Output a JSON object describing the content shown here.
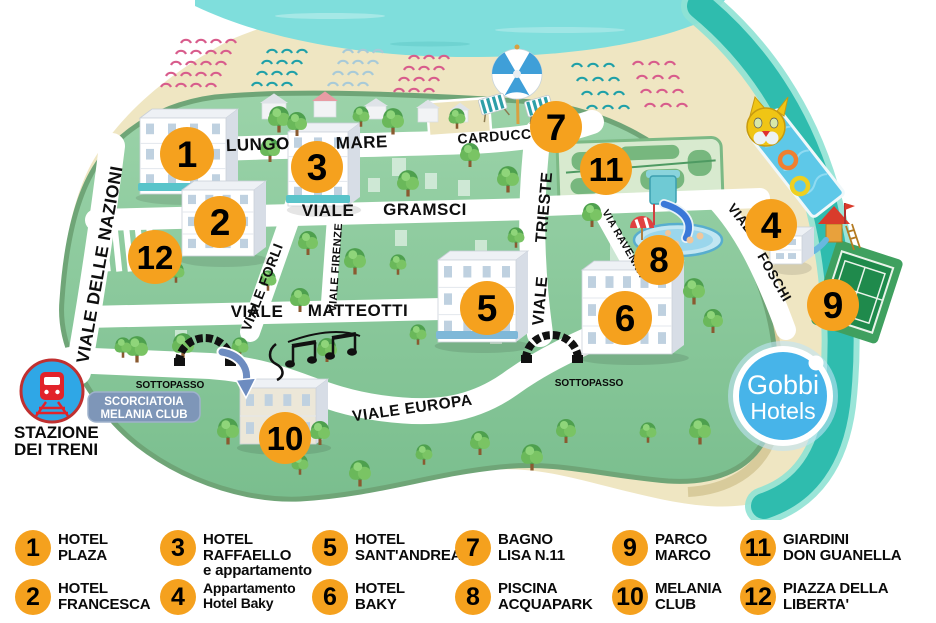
{
  "colors": {
    "marker_orange": "#F5A11E",
    "sea_turquoise": "#7FDEDC",
    "shore_teal": "#2FBCAE",
    "sand": "#EFE6C2",
    "land_green": "#8CC9A0",
    "street_white": "#FFFFFF",
    "label_black": "#111111",
    "scorciatoia_blue": "#7E96B8",
    "station_blue": "#2FA7E6",
    "train_red": "#E2232A",
    "gobbi_blue": "#47B4E9"
  },
  "map": {
    "marker_numbers": [
      "1",
      "2",
      "3",
      "4",
      "5",
      "6",
      "7",
      "8",
      "9",
      "10",
      "11",
      "12"
    ],
    "streets": {
      "nazioni": "VIALE DELLE NAZIONI",
      "lungo": "LUNGO",
      "mare": "MARE",
      "carducci": "CARDUCCI",
      "gramsci_word1": "VIALE",
      "gramsci_word2": "GRAMSCI",
      "matteotti_word1": "VIALE",
      "matteotti_word2": "MATTEOTTI",
      "trieste_word1": "VIALE",
      "trieste_word2": "TRIESTE",
      "forli": "VIALE FORLI",
      "firenze": "VIALE FIRENZE",
      "ravenna": "VIA RAVENNA",
      "foschi_word1": "VIALE",
      "foschi_word2": "FOSCHI",
      "europa": "VIALE EUROPA"
    },
    "labels": {
      "sottopasso_left": "SOTTOPASSO",
      "sottopasso_right": "SOTTOPASSO",
      "scorciatoia_line1": "SCORCIATOIA",
      "scorciatoia_line2": "MELANIA CLUB",
      "station_line1": "STAZIONE",
      "station_line2": "DEI TRENI",
      "gobbi_line1": "Gobbi",
      "gobbi_line2": "Hotels"
    }
  },
  "legend": {
    "items": [
      {
        "num": "1",
        "lines": [
          "HOTEL",
          "PLAZA"
        ]
      },
      {
        "num": "2",
        "lines": [
          "HOTEL",
          "FRANCESCA"
        ]
      },
      {
        "num": "3",
        "lines": [
          "HOTEL",
          "RAFFAELLO",
          "e appartamento"
        ]
      },
      {
        "num": "4",
        "lines": [
          "Appartamento",
          "Hotel Baky"
        ]
      },
      {
        "num": "5",
        "lines": [
          "HOTEL",
          "SANT'ANDREA"
        ]
      },
      {
        "num": "6",
        "lines": [
          "HOTEL",
          "BAKY"
        ]
      },
      {
        "num": "7",
        "lines": [
          "BAGNO",
          "LISA N.11"
        ]
      },
      {
        "num": "8",
        "lines": [
          "PISCINA",
          "ACQUAPARK"
        ]
      },
      {
        "num": "9",
        "lines": [
          "PARCO",
          "MARCO"
        ]
      },
      {
        "num": "10",
        "lines": [
          "MELANIA",
          "CLUB"
        ]
      },
      {
        "num": "11",
        "lines": [
          "GIARDINI",
          "DON GUANELLA"
        ]
      },
      {
        "num": "12",
        "lines": [
          "PIAZZA DELLA",
          "LIBERTA'"
        ]
      }
    ]
  }
}
